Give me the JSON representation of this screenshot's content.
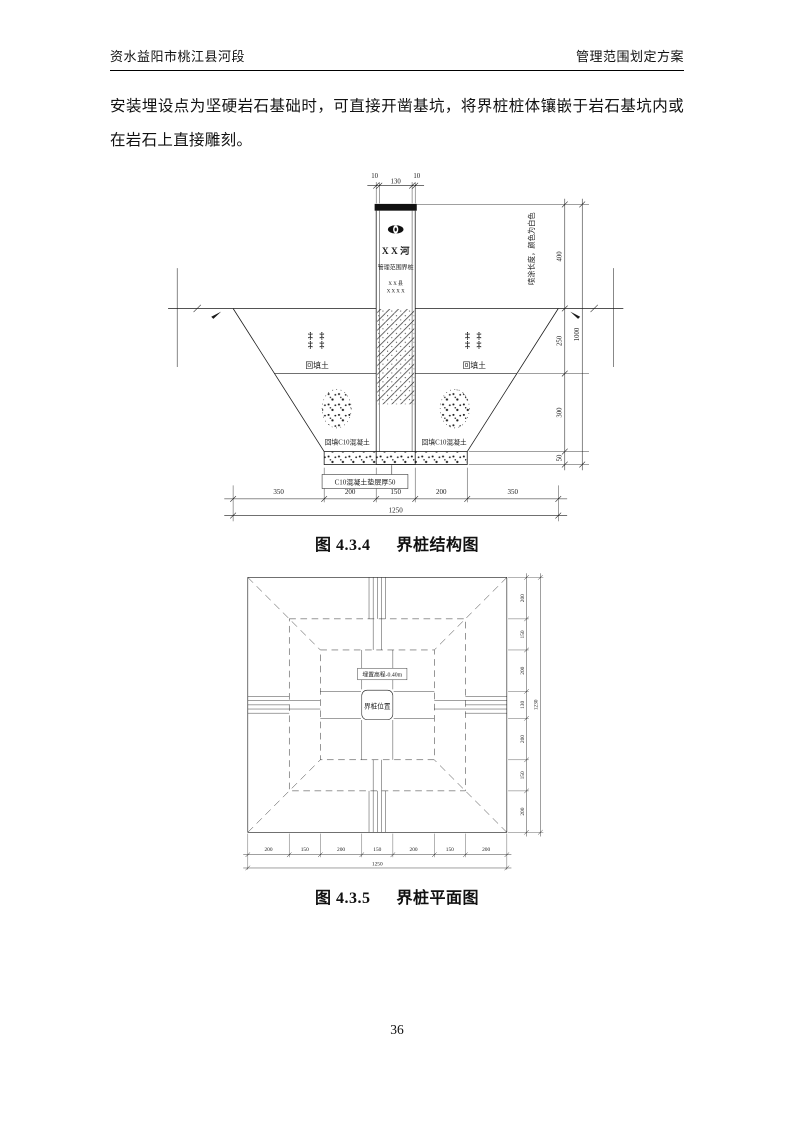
{
  "colors": {
    "ink": "#1a1a1a",
    "paper": "#ffffff"
  },
  "header": {
    "left": "资水益阳市桃江县河段",
    "right": "管理范围划定方案"
  },
  "paragraph": {
    "text": "安装埋设点为坚硬岩石基础时，可直接开凿基坑，将界桩桩体镶嵌于岩石基坑内或在岩石上直接雕刻。"
  },
  "figures": {
    "structure": {
      "caption_prefix": "图 4.3.4",
      "caption_title": "界桩结构图",
      "pile": {
        "emblem_icon": "river-authority-emblem",
        "river_name": "X X 河",
        "line2": "管理范围界桩",
        "line3": "X X 县",
        "line4": "X X X X"
      },
      "labels": {
        "soil_symbol": "‡ ‡",
        "backfill_soil": "回填土",
        "backfill_concrete": "回填C10混凝土",
        "cushion": "C10混凝土垫层厚50",
        "paint_note": "喷涂长度，颜色为白色"
      },
      "dims": {
        "top": [
          "10",
          "130",
          "10"
        ],
        "bottom_chain": [
          "350",
          "200",
          "150",
          "200",
          "350"
        ],
        "bottom_total": "1250",
        "right_chain": [
          "400",
          "250",
          "300",
          "50"
        ],
        "right_total": "1000"
      }
    },
    "plan": {
      "caption_prefix": "图 4.3.5",
      "caption_title": "界桩平面图",
      "labels": {
        "elevation": "埋置高程-0.40m",
        "pile_position": "界桩位置"
      },
      "dims": {
        "right_chain": [
          "200",
          "150",
          "200",
          "130",
          "200",
          "150",
          "200"
        ],
        "right_total": "1230",
        "bottom_chain": [
          "200",
          "150",
          "200",
          "150",
          "200",
          "150",
          "200"
        ],
        "bottom_total": "1250"
      }
    }
  },
  "footer": {
    "page_number": "36"
  }
}
